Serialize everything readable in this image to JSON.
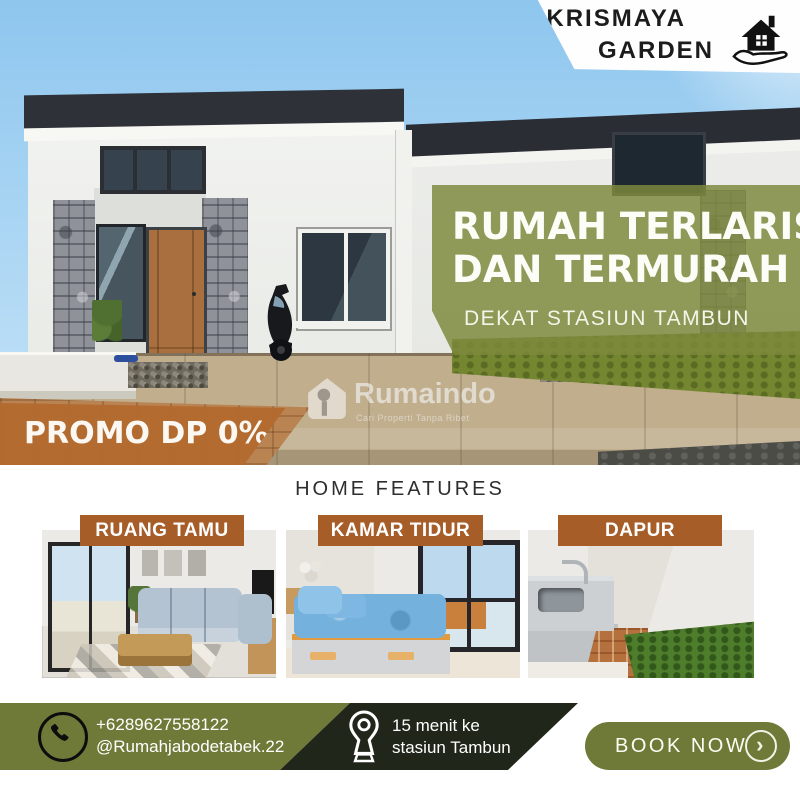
{
  "brand": {
    "line1": "KRISMAYA",
    "line2": "GARDEN",
    "logo": "house-in-hand-icon"
  },
  "hero": {
    "headline_line1": "RUMAH TERLARIS",
    "headline_line2": "DAN TERMURAH",
    "subheadline": "DEKAT STASIUN TAMBUN",
    "promo_badge": "PROMO DP 0%"
  },
  "watermark": {
    "name": "Rumaindo",
    "tagline": "Cari Properti Tanpa Ribet"
  },
  "features": {
    "heading": "HOME FEATURES",
    "cards": [
      {
        "label": "RUANG TAMU"
      },
      {
        "label": "KAMAR TIDUR"
      },
      {
        "label": "DAPUR"
      }
    ]
  },
  "footer": {
    "phone": "+6289627558122",
    "instagram": "@Rumahjabodetabek.22",
    "distance_line1": "15 menit ke",
    "distance_line2": "stasiun Tambun",
    "cta": "BOOK NOW"
  },
  "icons": {
    "chevron": "›"
  },
  "colors": {
    "olive": "#6f7a39",
    "olive_overlay": "#7d893d",
    "dark_green": "#20261a",
    "brown": "#a65d28",
    "promo_orange": "#b2692e",
    "text_dark": "#2e2e2e",
    "white": "#ffffff"
  }
}
